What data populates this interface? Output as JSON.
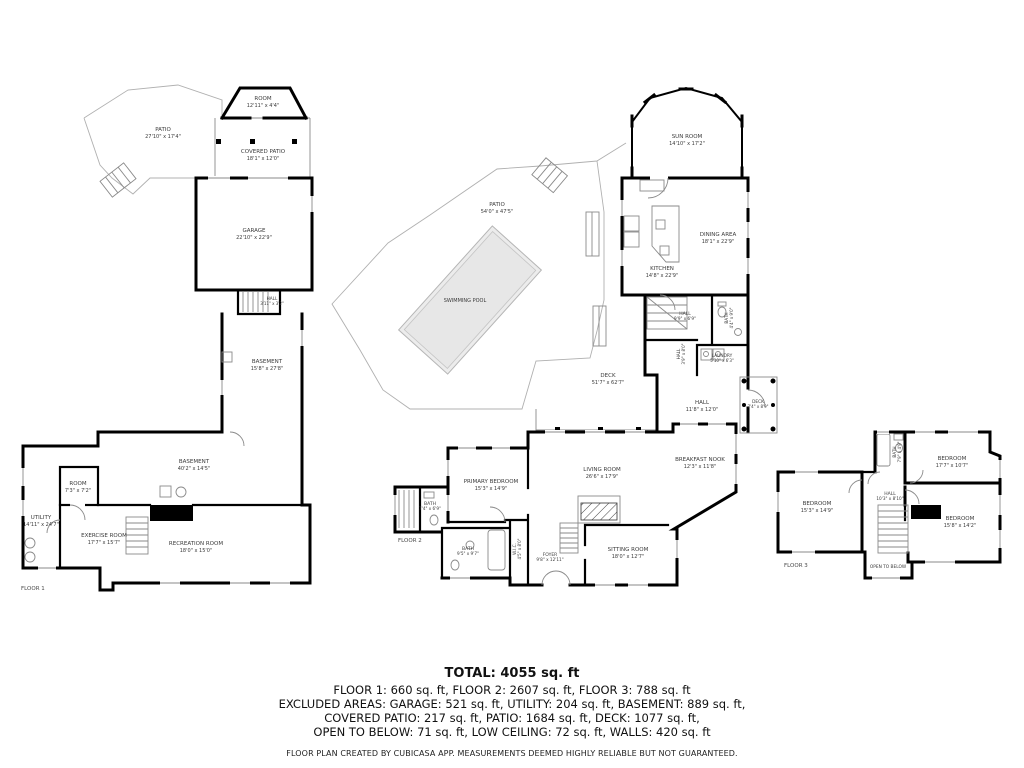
{
  "rooms": {
    "patio1": {
      "name": "PATIO",
      "dims": "27'10\" x 17'4\""
    },
    "room_top": {
      "name": "ROOM",
      "dims": "12'11\" x 4'4\""
    },
    "covered_patio": {
      "name": "COVERED PATIO",
      "dims": "18'1\" x 12'0\""
    },
    "garage": {
      "name": "GARAGE",
      "dims": "22'10\" x 22'9\""
    },
    "hall_f1": {
      "name": "HALL",
      "dims": "3'11\" x 3'2\""
    },
    "basement_u": {
      "name": "BASEMENT",
      "dims": "15'8\" x 27'8\""
    },
    "basement_l": {
      "name": "BASEMENT",
      "dims": "40'2\" x 14'5\""
    },
    "room_small": {
      "name": "ROOM",
      "dims": "7'3\" x 7'2\""
    },
    "utility": {
      "name": "UTILITY",
      "dims": "14'11\" x 24'7\""
    },
    "exercise": {
      "name": "EXERCISE ROOM",
      "dims": "17'7\" x 15'7\""
    },
    "recreation": {
      "name": "RECREATION ROOM",
      "dims": "18'0\" x 15'0\""
    },
    "patio2": {
      "name": "PATIO",
      "dims": "54'0\" x 47'5\""
    },
    "pool": {
      "name": "SWIMMING POOL",
      "dims": ""
    },
    "sun_room": {
      "name": "SUN ROOM",
      "dims": "14'10\" x 17'2\""
    },
    "dining": {
      "name": "DINING AREA",
      "dims": "18'1\" x 22'9\""
    },
    "kitchen": {
      "name": "KITCHEN",
      "dims": "14'8\" x 22'9\""
    },
    "hall_u2": {
      "name": "HALL",
      "dims": "9'9\" x 6'9\""
    },
    "bath_u2": {
      "name": "BATH",
      "dims": "4'4\" x 9'0\""
    },
    "hall_m2": {
      "name": "HALL",
      "dims": "3'9\" x 8'0\""
    },
    "laundry": {
      "name": "LAUNDRY",
      "dims": "5'10\" x 6'3\""
    },
    "deck_lg": {
      "name": "DECK",
      "dims": "51'7\" x 62'7\""
    },
    "hall_l2": {
      "name": "HALL",
      "dims": "11'8\" x 12'0\""
    },
    "deck_sm": {
      "name": "DECK",
      "dims": "7'4\" x 8'9\""
    },
    "primary": {
      "name": "PRIMARY BEDROOM",
      "dims": "15'3\" x 14'9\""
    },
    "living": {
      "name": "LIVING ROOM",
      "dims": "26'6\" x 17'9\""
    },
    "nook": {
      "name": "BREAKFAST NOOK",
      "dims": "12'3\" x 11'8\""
    },
    "bath_left": {
      "name": "BATH",
      "dims": "7'4\" x 6'9\""
    },
    "bath_low": {
      "name": "BATH",
      "dims": "9'5\" x 9'7\""
    },
    "wic": {
      "name": "W.I.C.",
      "dims": "4'5\" x 8'0\""
    },
    "foyer": {
      "name": "FOYER",
      "dims": "9'8\" x 12'11\""
    },
    "sitting": {
      "name": "SITTING ROOM",
      "dims": "18'0\" x 12'7\""
    },
    "bed_w": {
      "name": "BEDROOM",
      "dims": "15'3\" x 14'9\""
    },
    "bed_ne": {
      "name": "BEDROOM",
      "dims": "17'7\" x 10'7\""
    },
    "bed_se": {
      "name": "BEDROOM",
      "dims": "15'8\" x 14'2\""
    },
    "hall_f3": {
      "name": "HALL",
      "dims": "10'3\" x 8'10\""
    },
    "bath_f3": {
      "name": "BATH",
      "dims": "7'9\" x 4'9\""
    },
    "open_below": {
      "name": "OPEN TO BELOW",
      "dims": ""
    }
  },
  "floor_labels": {
    "f1": "FLOOR 1",
    "f2": "FLOOR 2",
    "f3": "FLOOR 3"
  },
  "title_block": {
    "total": "TOTAL: 4055 sq. ft",
    "floors_line": "FLOOR 1: 660 sq. ft, FLOOR 2: 2607 sq. ft, FLOOR 3: 788 sq. ft",
    "excluded_line1": "EXCLUDED AREAS: GARAGE: 521 sq. ft, UTILITY: 204 sq. ft, BASEMENT: 889 sq. ft,",
    "excluded_line2": "COVERED PATIO: 217 sq. ft, PATIO: 1684 sq. ft, DECK: 1077 sq. ft,",
    "excluded_line3": "OPEN TO BELOW: 71 sq. ft, LOW CEILING: 72 sq. ft, WALLS: 420 sq. ft",
    "disclaimer": "FLOOR PLAN CREATED BY CUBICASA APP. MEASUREMENTS DEEMED HIGHLY RELIABLE BUT NOT GUARANTEED."
  },
  "colors": {
    "wall": "#000000",
    "pool_fill": "#ececec",
    "low_ceiling": "#000000",
    "thin_line": "#8a8a8a"
  }
}
